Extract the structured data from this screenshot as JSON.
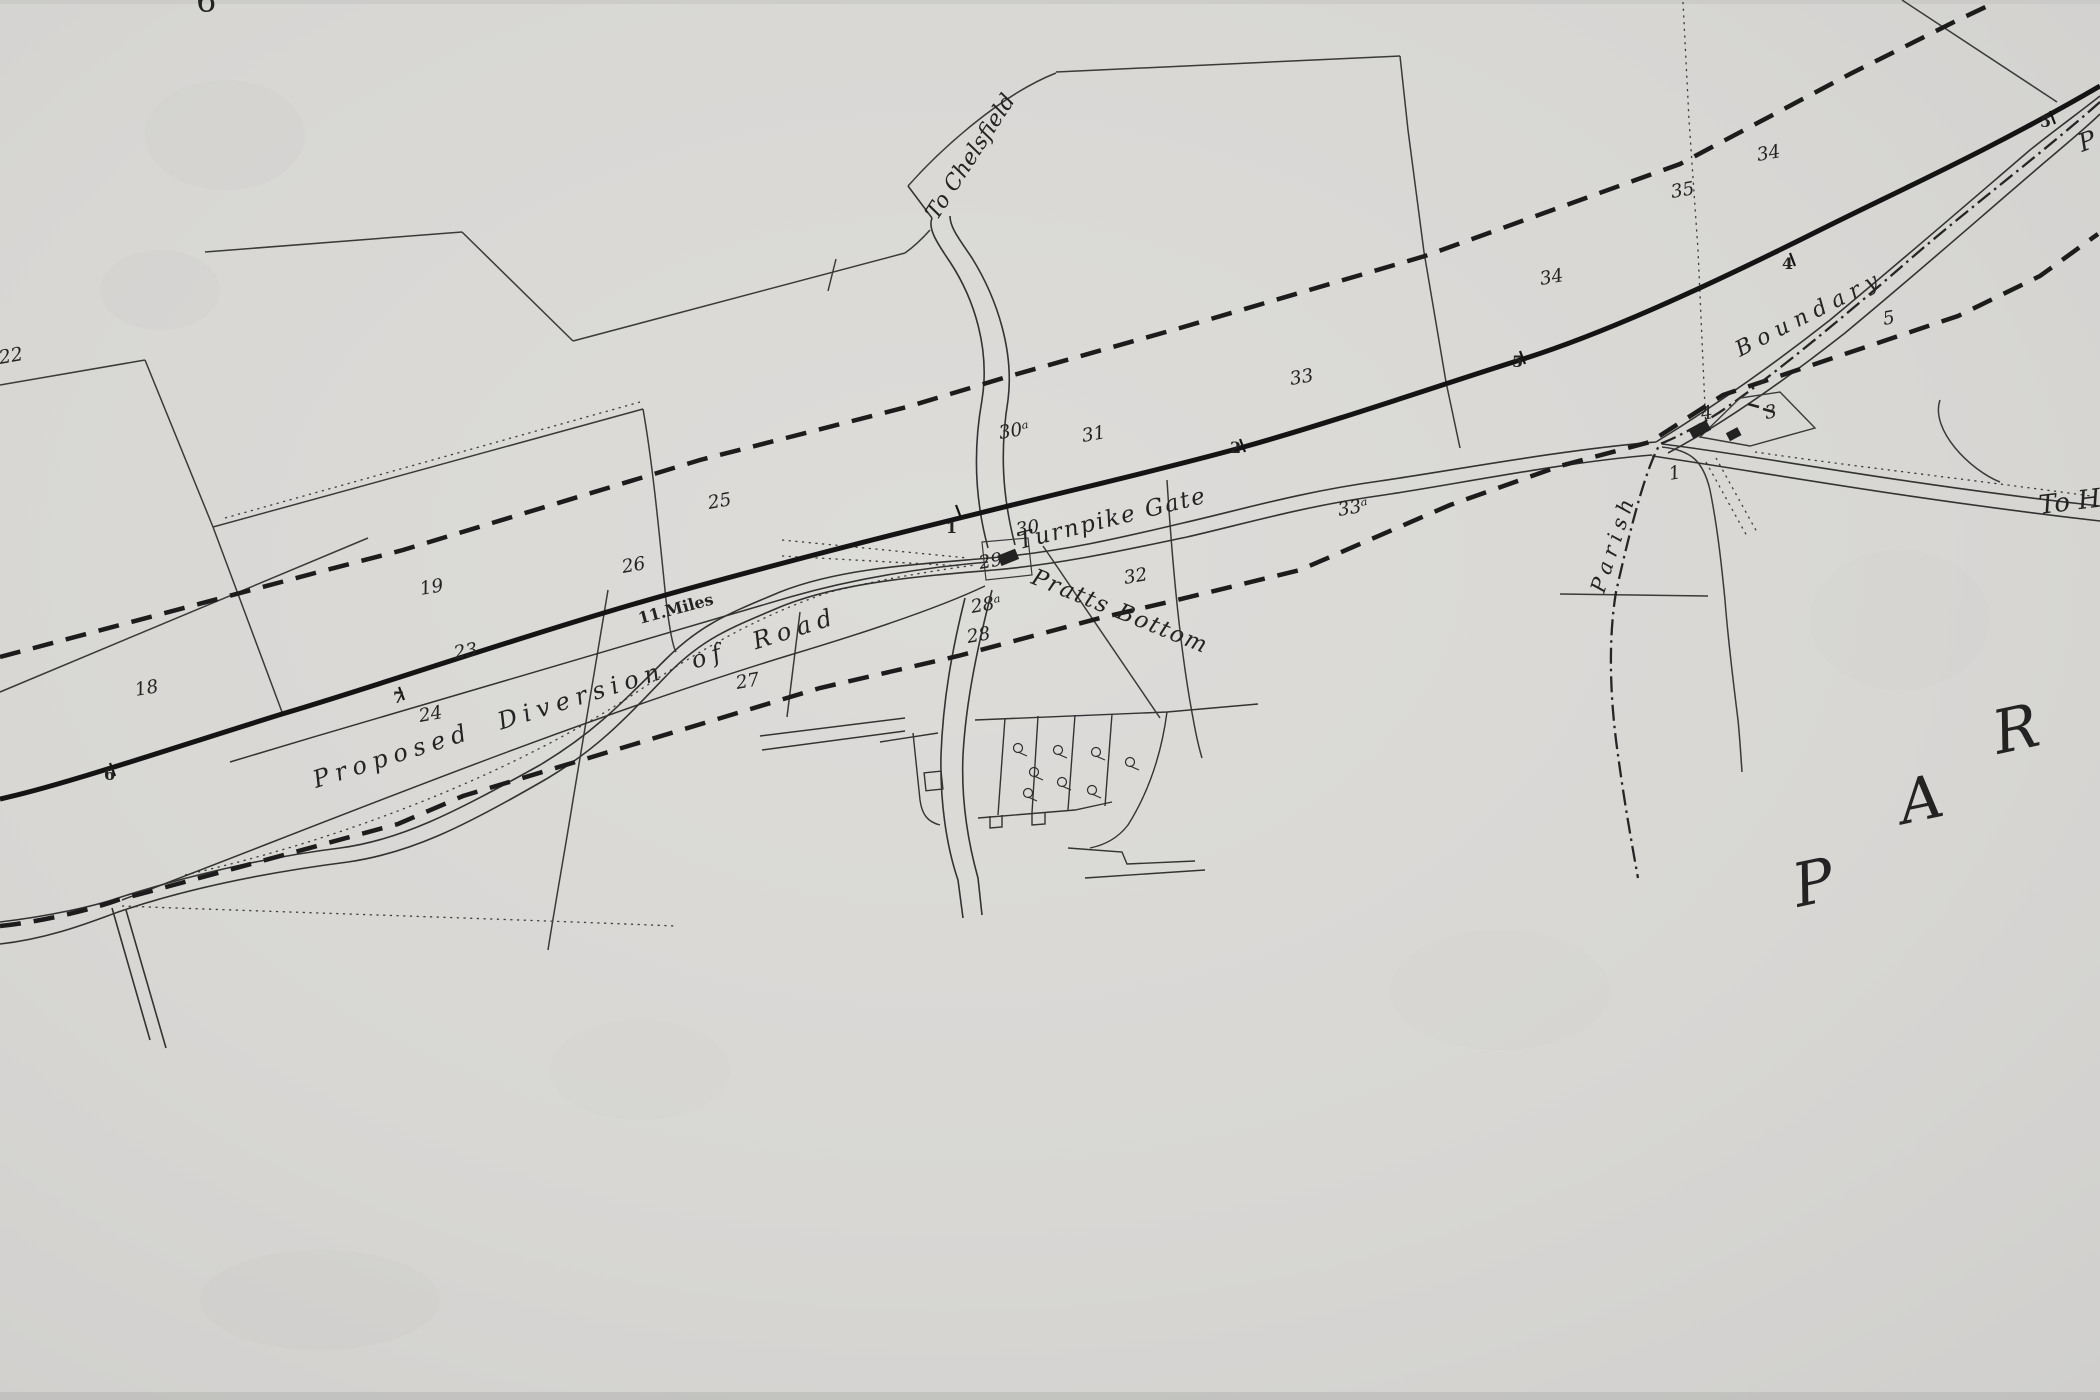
{
  "meta": {
    "description": "Scanned 19th-century surveyor plan: proposed diversion of turnpike road at Pratts Bottom",
    "paper_color": "#d9d8d5",
    "ink_color": "#232323"
  },
  "labels": {
    "to_chelsfield": "To Chelsfield",
    "turnpike_gate": "Turnpike Gate",
    "pratts_bottom": "Pratts Bottom",
    "proposed_diversion": "Proposed Diversion of Road",
    "eleven_miles": "11.Miles",
    "parish": "Parish",
    "boundary": "Boundary",
    "to_ha": "To Ha",
    "par_p": "P",
    "par_a": "A",
    "par_r": "R",
    "edge_p": "P",
    "edge_22": "22",
    "edge_6": "6"
  },
  "parcel_numbers": {
    "n18": "18",
    "n19": "19",
    "n23": "23",
    "n24": "24",
    "n25": "25",
    "n26": "26",
    "n27": "27",
    "n28": "28",
    "n28a": "28ᵃ",
    "n29": "29",
    "n30": "30",
    "n30a": "30ᵃ",
    "n31": "31",
    "n32": "32",
    "n33": "33",
    "n33a": "33ᵃ",
    "n34a": "34",
    "n34b": "34",
    "n35": "35",
    "n5f": "5",
    "n4h": "4",
    "n3h": "3",
    "n1f": "1"
  },
  "milestones": {
    "m6": "6",
    "m7": "7",
    "m1": "1",
    "m2": "2",
    "m5a": "5",
    "m4": "4",
    "m5b": "5"
  }
}
